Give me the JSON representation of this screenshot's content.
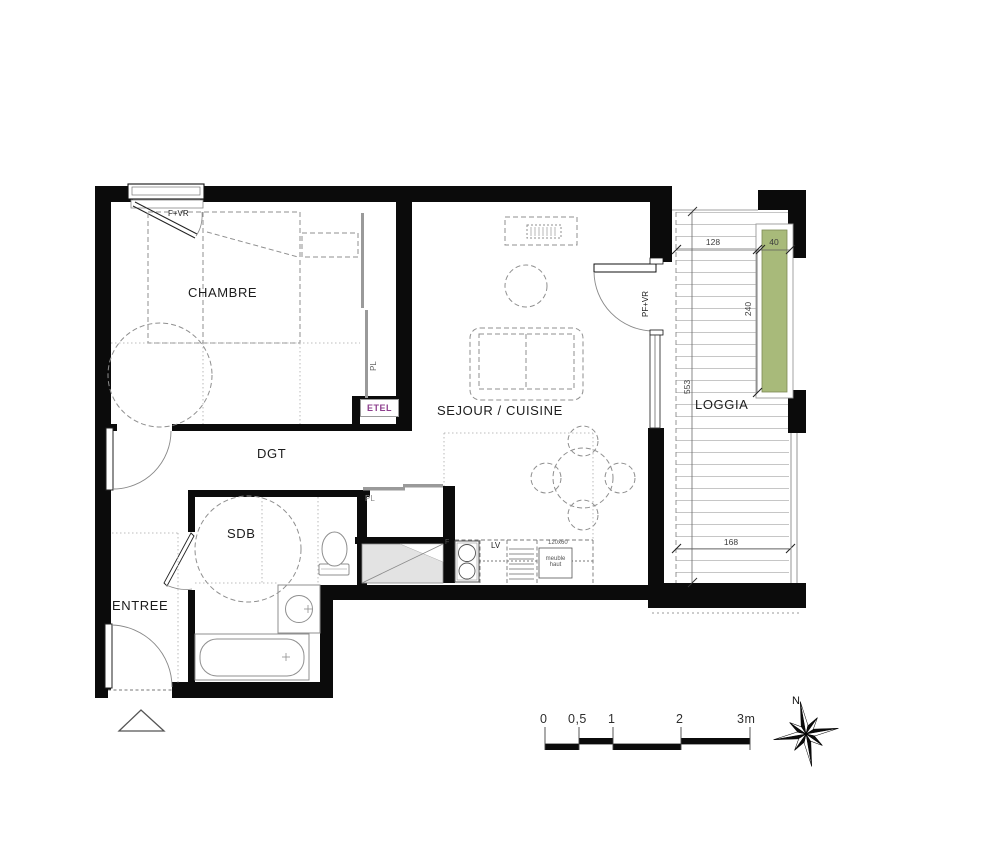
{
  "rooms": {
    "chambre": "CHAMBRE",
    "sejour": "SEJOUR / CUISINE",
    "dgt": "DGT",
    "sdb": "SDB",
    "entree": "ENTREE",
    "loggia": "LOGGIA"
  },
  "openings": {
    "chambre_window": "F+VR",
    "loggia_door": "PF+VR"
  },
  "closets": {
    "chambre_closet": "PL",
    "hallway_closet": "PL",
    "technical_closet": "ETEL"
  },
  "kitchen": {
    "oven": "F",
    "dishwasher": "LV",
    "counter_size": "120x60",
    "wall_unit": "meuble haut"
  },
  "dimensions_cm": {
    "loggia_top_width": "128",
    "planter_width": "40",
    "planter_length": "240",
    "loggia_depth": "553",
    "loggia_bottom_width": "168"
  },
  "scale_bar": {
    "labels": [
      "0",
      "0,5",
      "1",
      "2",
      "3m"
    ]
  },
  "compass": {
    "north": "N"
  },
  "colors": {
    "wall": "#0b0b0b",
    "planter_green": "#a8ba7a",
    "etel_purple": "#8d3f8d",
    "shaft_gray": "#e3e3e3"
  }
}
